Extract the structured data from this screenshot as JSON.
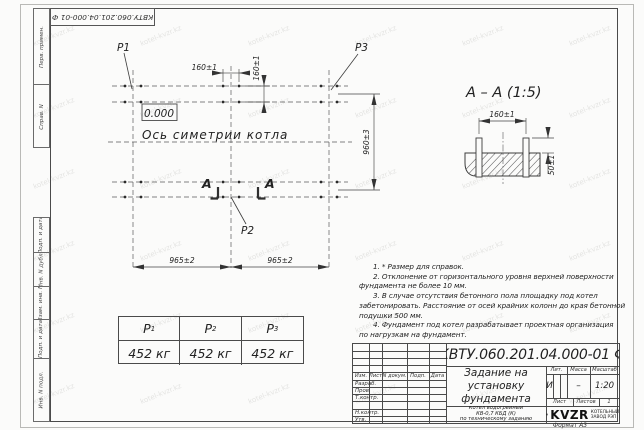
{
  "watermark": {
    "text": "kotel-kvzr.kz"
  },
  "stamp": {
    "number_rotated": "КВТУ.060.201.04.000-01  Ф"
  },
  "frame_strips": {
    "top": [
      {
        "label": "Перв. примен."
      },
      {
        "label": "Справ. N"
      }
    ],
    "bottom": [
      {
        "label": "Подп. и дата"
      },
      {
        "label": "Инв. N дубл."
      },
      {
        "label": "Взам. инв. N"
      },
      {
        "label": "Подп. и дата"
      },
      {
        "label": "Инв. N подл."
      }
    ]
  },
  "plan": {
    "point_labels": {
      "p1": "Р1",
      "p2": "Р2",
      "p3": "Р3"
    },
    "elevation": "0.000",
    "axis_label": "Ось симетрии котла",
    "section_letter_left": "А",
    "section_letter_right": "А",
    "dims": {
      "bolt_h": "160±1",
      "bolt_v": "160±1",
      "span_left": "965±2",
      "span_right": "965±2",
      "depth": "960±3"
    }
  },
  "section_view": {
    "title": "А – А (1:5)",
    "dims": {
      "bolt": "160±1",
      "height": "50±1"
    }
  },
  "loads_table": {
    "headers": [
      {
        "base": "Р",
        "sub": "1"
      },
      {
        "base": "Р",
        "sub": "2"
      },
      {
        "base": "Р",
        "sub": "3"
      }
    ],
    "values": [
      "452 кг",
      "452 кг",
      "452 кг"
    ]
  },
  "notes": {
    "lines": [
      "1. * Размер для справок.",
      "2. Отклонение от горизонтального уровня верхней поверхности",
      "фундамента не более 10 мм.",
      "3. В случае отсутствия бетонного пола площадку под котел",
      "забетонировать. Расстояние от осей крайних колонн до края бетонной",
      "подушки 500 мм.",
      "4. Фундамент под котел разрабатывает проектная организация",
      "по нагрузкам на фундамент."
    ]
  },
  "title_block": {
    "doc_number": "КВТУ.060.201.04.000-01  Ф",
    "header_cells": [
      "Изм.",
      "Лист",
      "N докум.",
      "Подп.",
      "Дата"
    ],
    "rows": [
      "Разраб.",
      "Пров.",
      "Т.контр.",
      "Н.контр.",
      "Утв."
    ],
    "title_lines": [
      "Задание на",
      "установку",
      "фундамента"
    ],
    "subtitle_lines": [
      "Котел водогрейный",
      "КВ-0,7 КБД (К)",
      "по техническому заданию"
    ],
    "lit": {
      "label": "Лит.",
      "value": "И"
    },
    "mass": {
      "label": "Масса",
      "value": "–"
    },
    "scale": {
      "label": "Масштаб",
      "value": "1:20"
    },
    "sheet": {
      "label": "Лист",
      "total_label": "Листов",
      "total_value": "1"
    },
    "company": {
      "logo": "KVZR",
      "name_line1": "КОТЕЛЬНЫЙ",
      "name_line2": "ЗАВОД РЭП"
    },
    "format": "Формат А3"
  }
}
